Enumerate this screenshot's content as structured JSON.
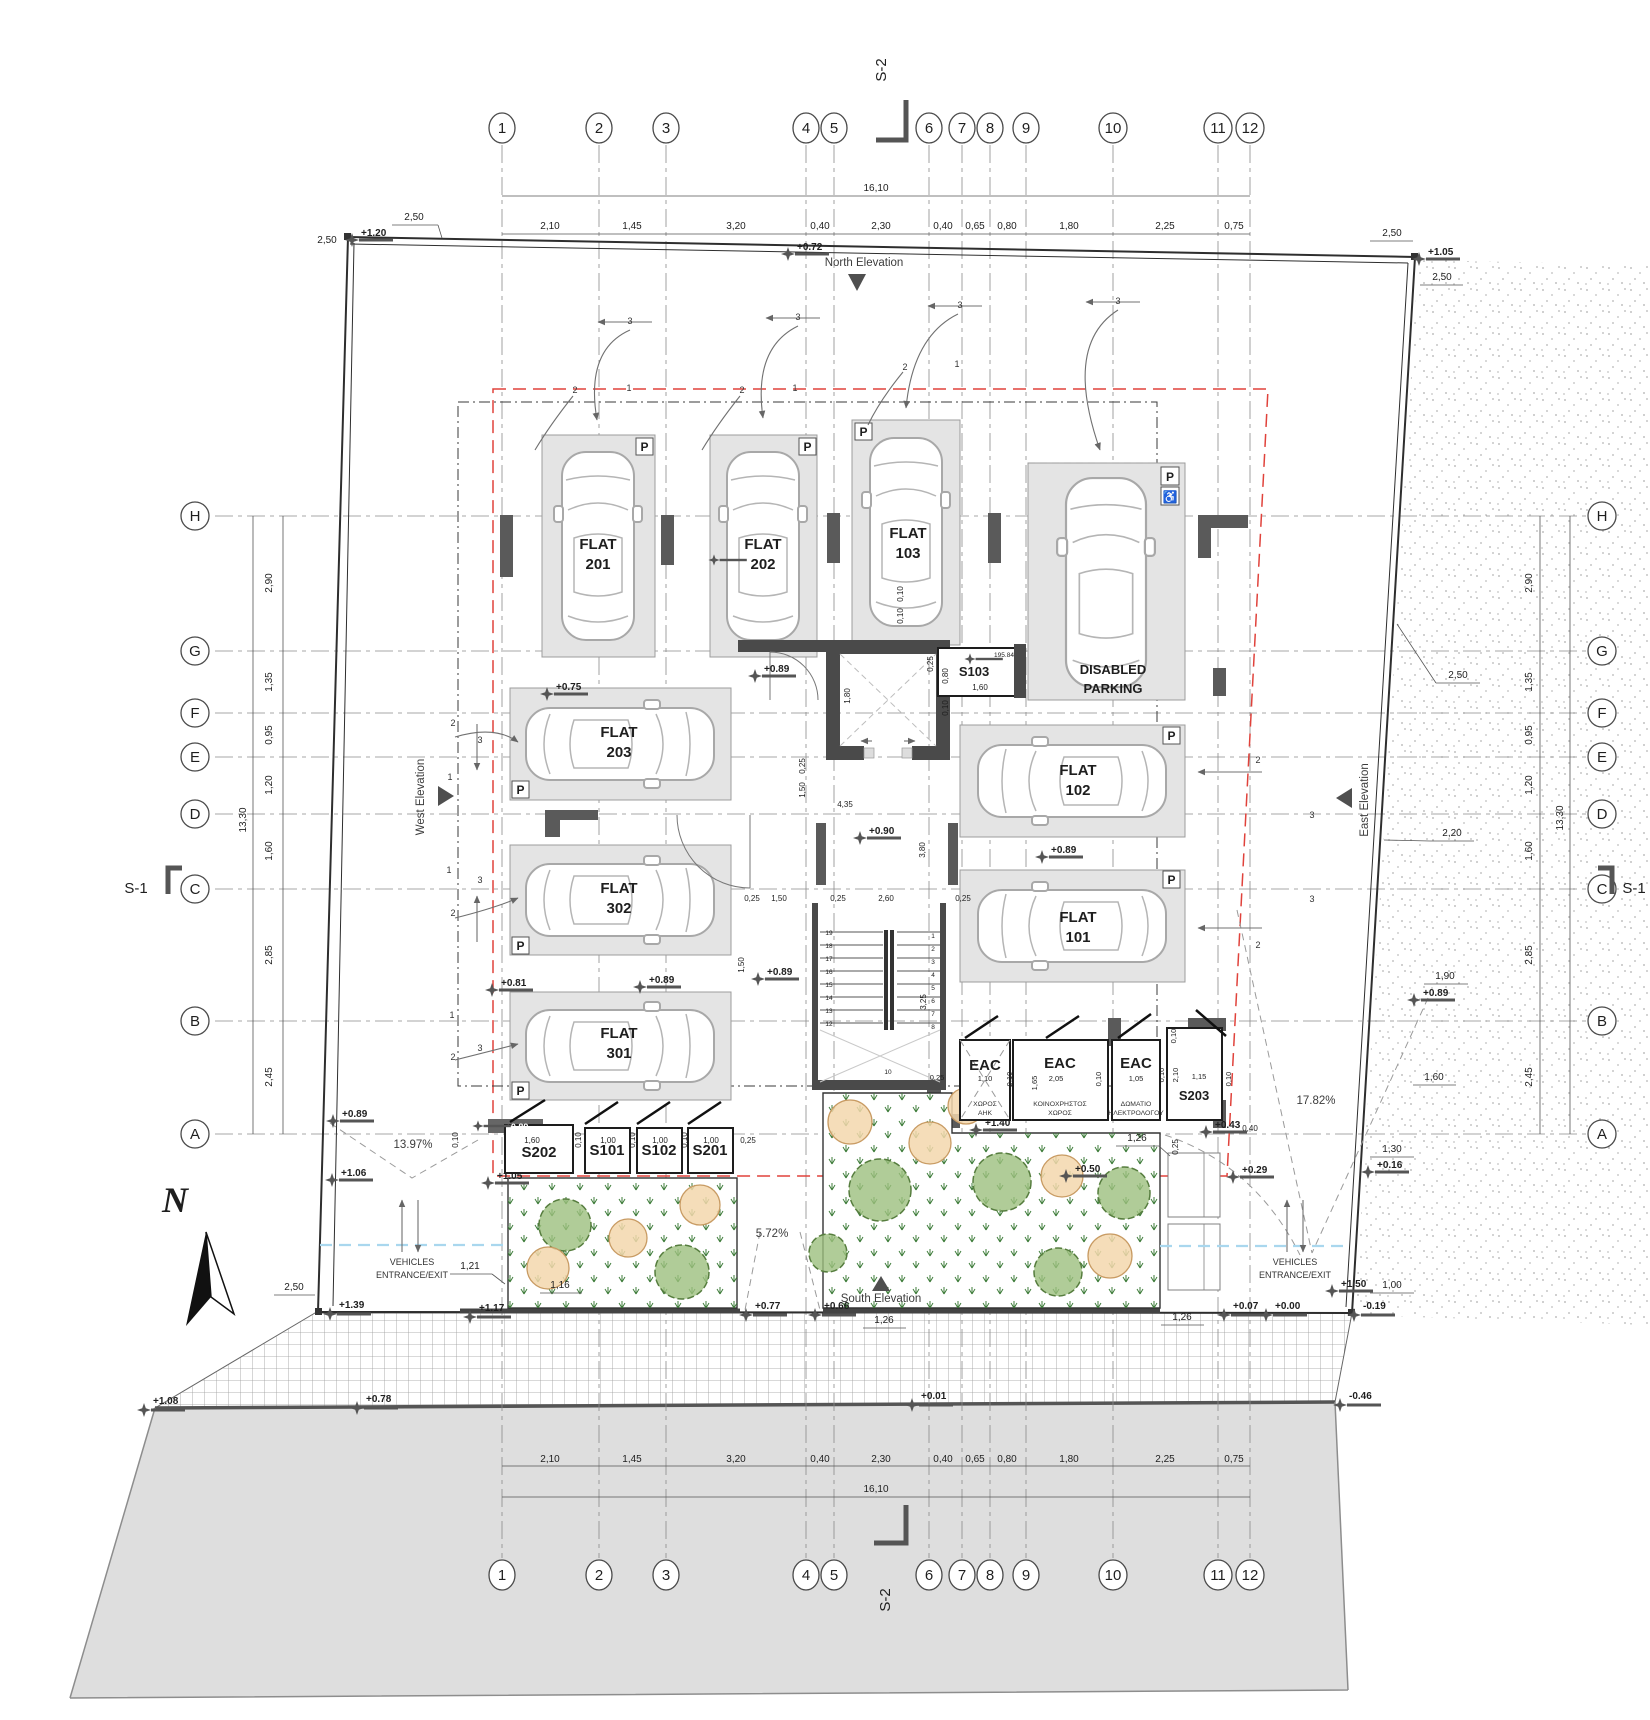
{
  "drawing": {
    "parking_letter": "P",
    "disabled_icon": "♿",
    "compass_letter": "N"
  },
  "grid": {
    "cols": [
      "1",
      "2",
      "3",
      "4",
      "5",
      "6",
      "7",
      "8",
      "9",
      "10",
      "11",
      "12"
    ],
    "rows": [
      "H",
      "G",
      "F",
      "E",
      "D",
      "C",
      "B",
      "A"
    ]
  },
  "dims": {
    "top": [
      "2,10",
      "1,45",
      "3,20",
      "0,40",
      "2,30",
      "0,40",
      "0,65",
      "0,80",
      "1,80",
      "2,25",
      "0,75"
    ],
    "total_width": "16,10",
    "side": [
      "2,90",
      "1,35",
      "0,95",
      "1,20",
      "1,60",
      "2,85",
      "2,45"
    ],
    "total_height": "13,30"
  },
  "sections": {
    "s1": "S-1",
    "s2": "S-2"
  },
  "elevation_markers": {
    "north": "North Elevation",
    "south": "South Elevation",
    "west": "West Elevation",
    "east": "East Elevation"
  },
  "stalls": {
    "f201": {
      "l1": "FLAT",
      "l2": "201"
    },
    "f202": {
      "l1": "FLAT",
      "l2": "202"
    },
    "f103": {
      "l1": "FLAT",
      "l2": "103"
    },
    "f203": {
      "l1": "FLAT",
      "l2": "203"
    },
    "f302": {
      "l1": "FLAT",
      "l2": "302"
    },
    "f301": {
      "l1": "FLAT",
      "l2": "301"
    },
    "f102": {
      "l1": "FLAT",
      "l2": "102"
    },
    "f101": {
      "l1": "FLAT",
      "l2": "101"
    },
    "disabled": {
      "l1": "DISABLED",
      "l2": "PARKING"
    }
  },
  "storage": {
    "s202": "S202",
    "s101": "S101",
    "s102": "S102",
    "s201": "S201",
    "s103": "S103",
    "s203": "S203"
  },
  "eac": {
    "label": "EAC",
    "room1_l1": "ΧΩΡΟΣ",
    "room1_l2": "ΑΗΚ",
    "room2_l1": "ΚΟΙΝΟΧΡΗΣΤΟΣ",
    "room2_l2": "ΧΩΡΟΣ",
    "room3_l1": "ΔΩΜΑΤΙΟ",
    "room3_l2": "ΗΛΕΚΤΡΟΛΟΓΟΥ"
  },
  "entrance": {
    "l1": "VEHICLES",
    "l2": "ENTRANCE/EXIT"
  },
  "slopes": {
    "west_ramp": "13.97%",
    "south_ramp": "5.72%",
    "east_ramp": "17.82%"
  },
  "spots": {
    "tl": "+1.20",
    "north": "+0.72",
    "tr": "+1.05",
    "f203_top": "+0.75",
    "core_nw": "+0.89",
    "lobby": "+0.90",
    "f301_left": "+0.81",
    "f301_right": "+0.89",
    "stair_west": "+0.89",
    "f101_top": "+0.89",
    "east_bound": "+0.89",
    "storage_bar": "+0.89",
    "storage_low": "+1.05",
    "eac_floor": "+1.40",
    "se_a": "+0.43",
    "se_b": "+0.29",
    "garden_e": "+0.50",
    "east_low": "+0.16",
    "se_high": "+1.50",
    "bl": "+1.39",
    "south_a": "+1.17",
    "south_b": "+0.77",
    "south_c": "+0.66",
    "south_d": "+0.07",
    "south_e": "+0.00",
    "south_f": "-0.19",
    "corner_se": "-0.46",
    "road_w": "+1.08",
    "road_a": "+0.78",
    "road_b": "+0.01",
    "west_a": "+0.89",
    "west_b": "+1.06",
    "s103_area": "195.84"
  },
  "site_dims": {
    "c250": "2,50",
    "r220": "2,20",
    "r190": "1,90",
    "r160": "1,60",
    "r130": "1,30",
    "r100": "1,00",
    "g121": "1,21",
    "g116": "1,16",
    "g126": "1,26",
    "b040": "0,40"
  },
  "core_dims": {
    "lobby_w": "4,35",
    "lobby_h": "3,80",
    "stair_w": "2,60",
    "hall": "1,50",
    "wall": "0,25",
    "elev": "1,80",
    "stair_h": "3,25",
    "gap": "0,10",
    "s103_w": "1,60",
    "s103_h": "0,80",
    "tread10": "10"
  },
  "storage_dims": {
    "w202": "1,60",
    "w1": "1,00"
  },
  "eac_dims": {
    "w1": "1,10",
    "w2": "2,05",
    "w3": "1,05",
    "h": "1,65",
    "s203_w": "1,15",
    "s203_h": "2,10"
  },
  "stair": {
    "left": [
      "19",
      "18",
      "17",
      "16",
      "15",
      "14",
      "13",
      "12"
    ],
    "right": [
      "1",
      "2",
      "3",
      "4",
      "5",
      "6",
      "7",
      "8"
    ]
  },
  "swing": {
    "n1": "1",
    "n2": "2",
    "n3": "3"
  }
}
